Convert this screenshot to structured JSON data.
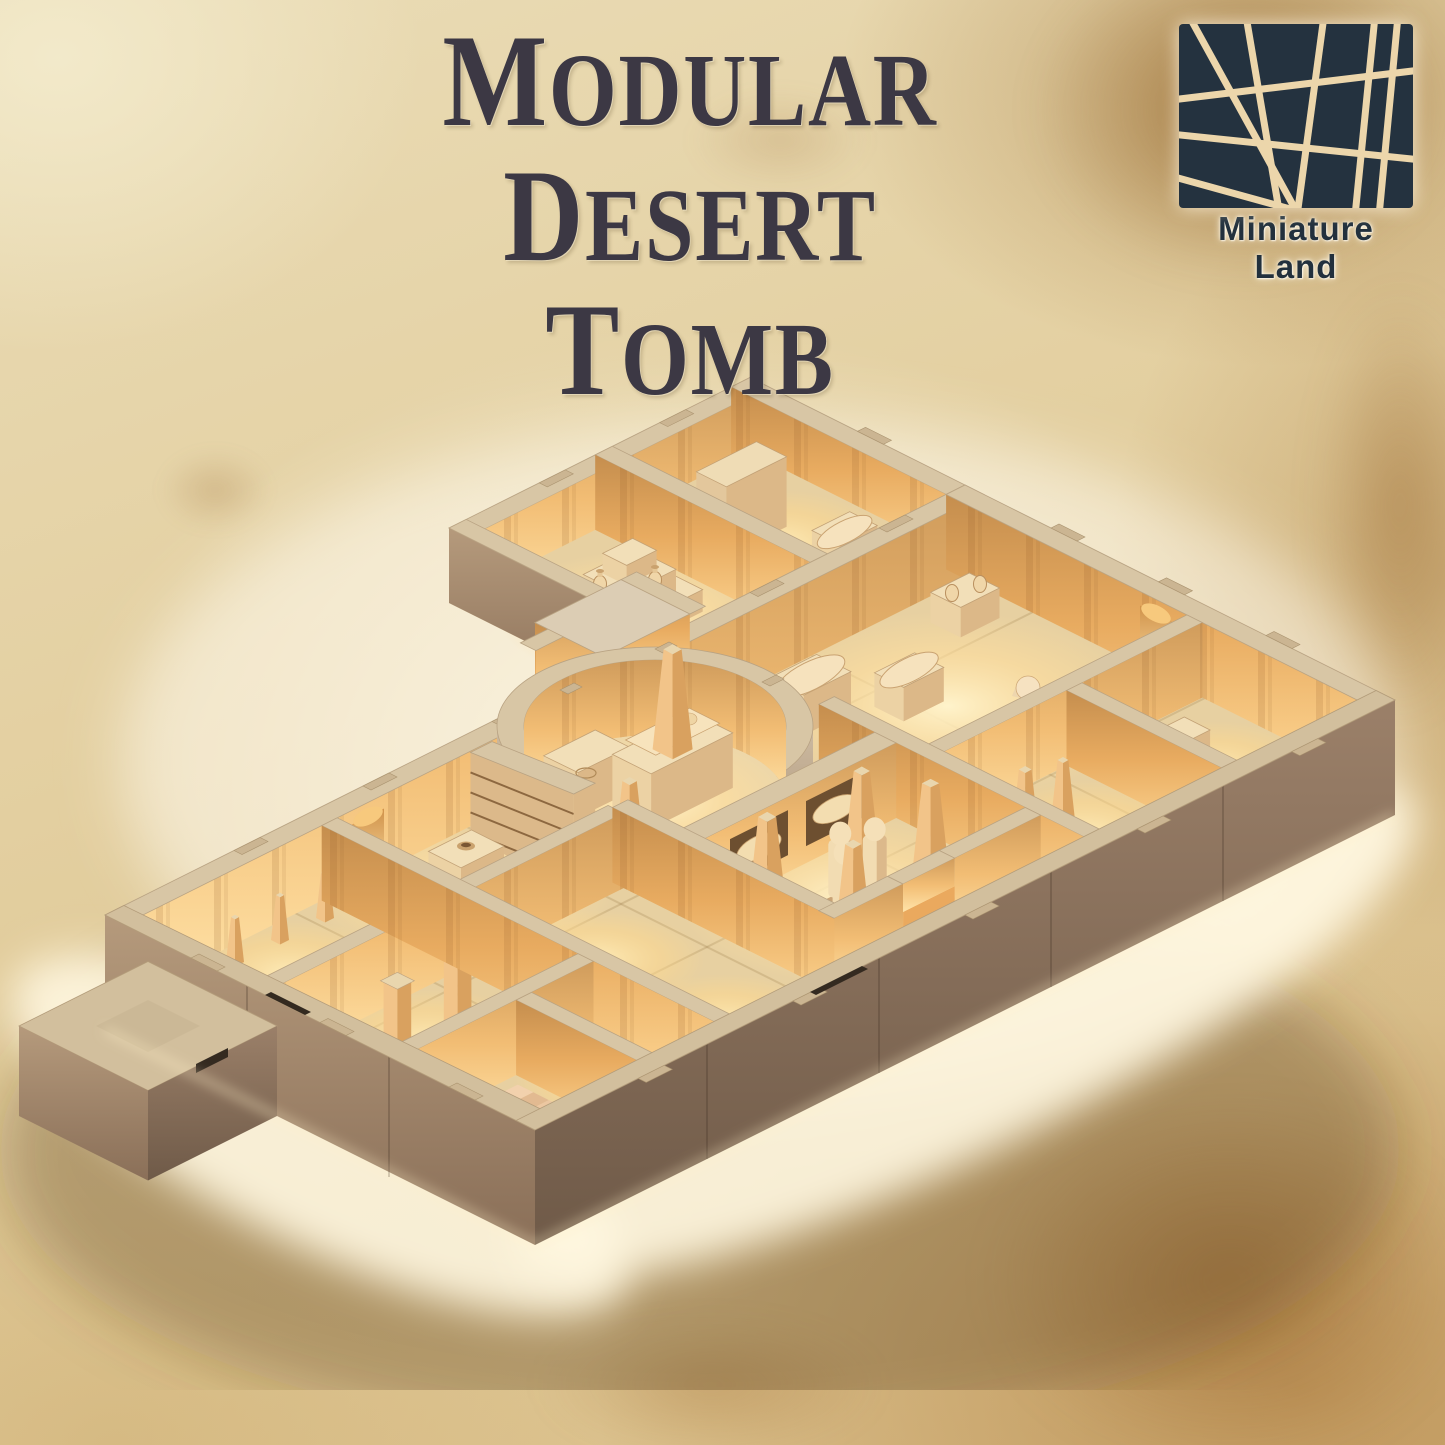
{
  "poster": {
    "title": {
      "line1": {
        "initial": "M",
        "rest": "ODULAR"
      },
      "line2": {
        "initial": "D",
        "rest": "ESERT"
      },
      "line3": {
        "initial": "T",
        "rest": "OMB"
      }
    },
    "brand": {
      "name": "Miniature Land"
    },
    "colors": {
      "parchment_base": "#e2cfa2",
      "parchment_light": "#f6efd6",
      "parchment_stain": "#a87b42",
      "title_ink": "#3c3844",
      "logo_navy": "#24323f",
      "logo_lines": "#ecd6ab",
      "model_sand": "#d8c6a5",
      "model_glow": "#ffdf9f",
      "model_dark_side": "#6f5a48"
    },
    "scene": {
      "description": "Isometric photo of a 3D-printed modular desert tomb tabletop terrain with warmly lit sand-colored rooms",
      "features": [
        "circular-tomb-chamber",
        "sarcophagus",
        "altar",
        "obelisks",
        "pharaoh-busts",
        "mummy-niches",
        "treasure-chests",
        "sphinx-statue",
        "shrine-altar",
        "library-shelves",
        "staircase",
        "entrance-porch",
        "columned-halls",
        "vases"
      ]
    }
  }
}
